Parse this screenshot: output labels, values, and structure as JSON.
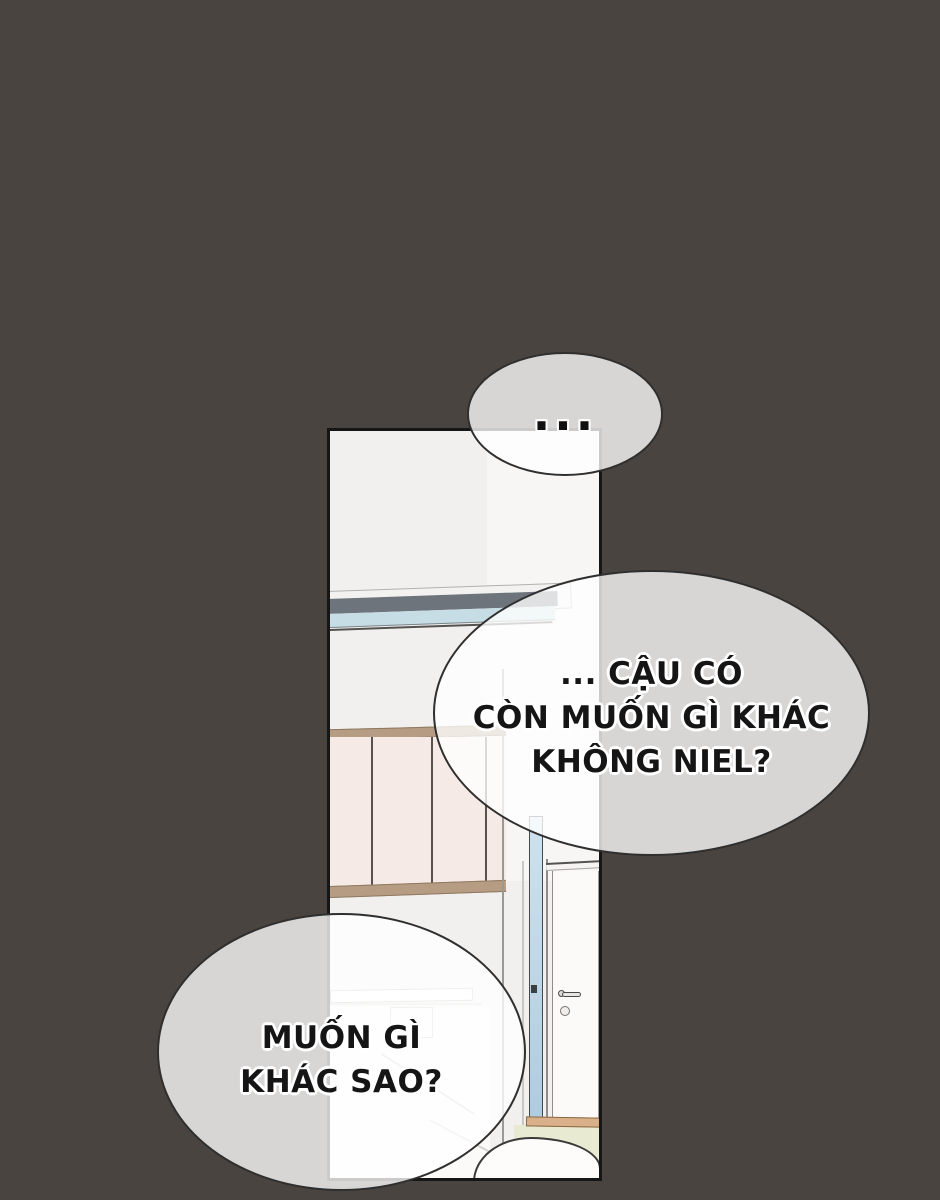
{
  "scene": {
    "type": "webtoon comic panel",
    "colors": {
      "background": "#4a4441",
      "panel_border": "#161616",
      "wall": "#f2f0ef",
      "wall_light": "#f8f6f4",
      "bubble_fill": "rgba(255,255,255,0.78)",
      "bubble_border": "#2f2f2f",
      "rail_dark": "#6d747b",
      "rail_blue": "#c7dde5",
      "wood_trim": "#b59c83",
      "wardrobe_door": "#f6eae6",
      "door_edge_blue": "#bcd5e8",
      "floor_green": "#e8ebd2",
      "threshold_tan": "#d9b089",
      "text": "#151515"
    }
  },
  "bubbles": {
    "top": {
      "text": "..."
    },
    "middle": {
      "text": "... CẬU CÓ\nCÒN MUỐN GÌ KHÁC\nKHÔNG NIEL?"
    },
    "bottom": {
      "text": "MUỐN GÌ\nKHÁC SAO?"
    }
  }
}
